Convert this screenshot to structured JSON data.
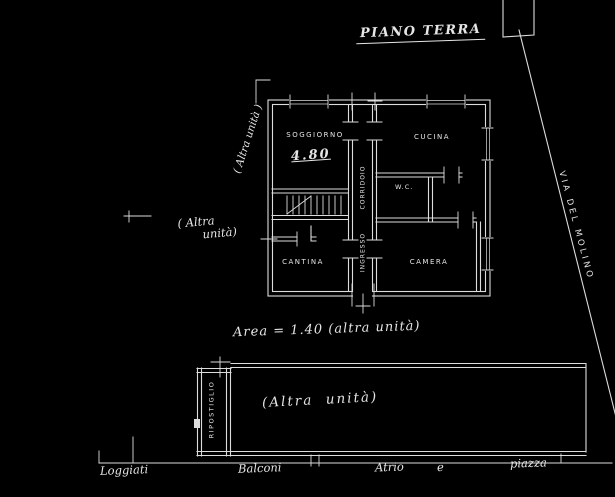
{
  "title": "PIANO TERRA",
  "rooms": {
    "soggiorno": "SOGGIORNO",
    "soggiorno_dim": "4.80",
    "cucina": "CUCINA",
    "wc": "W.C.",
    "cantina": "CANTINA",
    "camera": "CAMERA",
    "corridoio": "CORRIDOIO",
    "ingresso": "INGRESSO",
    "ripostiglio": "RIPOSTIGLIO"
  },
  "annotations": {
    "left_unit_rotated": "( Altra unità )",
    "left_unit_line1": "( Altra",
    "left_unit_line2": "unità)",
    "area_note": "Area = 1.40 (altra unità)",
    "lower_block_note": "(Altra  unità)",
    "street_name": "VIA DEL MOLINO"
  },
  "ground_labels": {
    "l1": "Loggiati",
    "l2": "Balconi",
    "l3": "Atrio",
    "l4": "e",
    "l5": "piazza"
  },
  "colors": {
    "background": "#000000",
    "ink": "#e6e6e6"
  }
}
